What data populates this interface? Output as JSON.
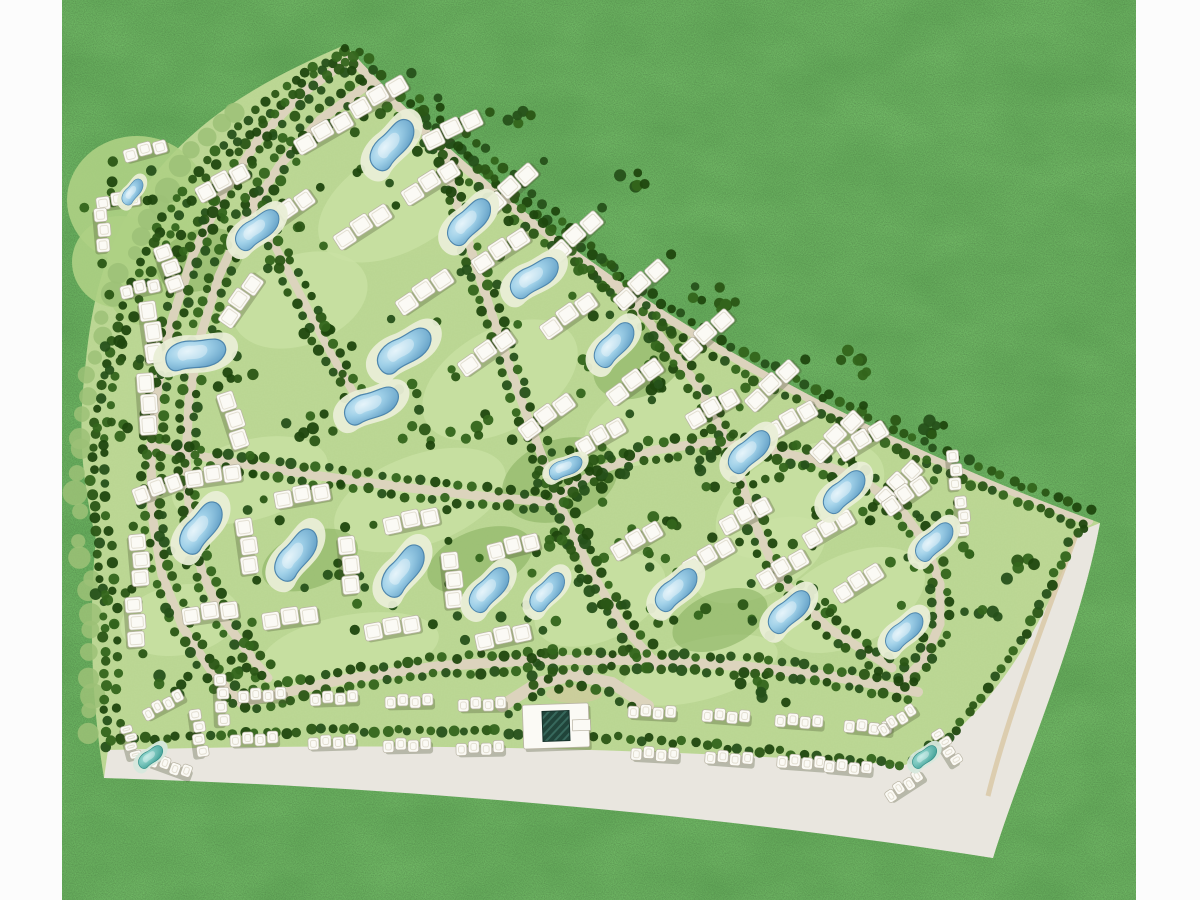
{
  "map": {
    "aria_label": "Aerial master plan site map of a fan-shaped residential community with apartment blocks, swimming pools, tree-lined roads, a clubhouse and perimeter roads on a grass field",
    "type": "masterplan-siteplan",
    "visible_text": "none"
  },
  "canvas": {
    "width": 1200,
    "height": 900
  },
  "palette": {
    "page_bg": "#fdfdfd",
    "grass_base": "#46763a",
    "margin_white": "#fcfcfc",
    "lawn": "#b4d28a",
    "lawn_light": "#c9e2a4",
    "lawn_dark": "#8ab263",
    "halo": "#aed084",
    "fringe": "#9cc177",
    "road": "#ddd3bf",
    "road_band": "#e9e6df",
    "road_tan": "#d8c7a2",
    "tree_colors": [
      "#1f470e",
      "#2a5615",
      "#33651b",
      "#26511a"
    ],
    "building_fill": "#fbfaf5",
    "building_stroke": "#b9b4a4",
    "building_inner": "#e3dfd2",
    "building_shadow": "rgba(70,80,45,0.30)",
    "pool_deck": "#e9eed6",
    "pool_stroke": "#4e86ad",
    "teal_deck": "#d6e8dc",
    "teal_stroke": "#2e8c84",
    "clubhouse_core": "#20443a",
    "clubhouse_hatch": "#37685c"
  },
  "margins": {
    "left": {
      "x": 0,
      "w": 62
    },
    "right": {
      "x": 1136,
      "w": 64
    }
  },
  "site": {
    "outline": "M345,45 Q622,348 1100,523 C1078,640 1020,770 993,858 C700,810 380,783 104,778 C92,706 88,616 96,540 C80,470 78,428 86,360 C92,300 106,238 150,180 C198,118 262,80 345,45 Z",
    "band": "M108,750 C400,742 640,748 905,765 C975,735 1040,640 1078,532 L1100,523 C1078,640 1020,770 993,858 C700,812 380,786 104,778 Z",
    "tan_strip": "M1076,535 C1042,626 1006,722 988,796"
  },
  "roads": {
    "paths": {
      "A1": [
        [
          348,
          60
        ],
        [
          300,
          95
        ],
        [
          258,
          140
        ],
        [
          222,
          195
        ],
        [
          193,
          255
        ],
        [
          172,
          320
        ],
        [
          158,
          385
        ],
        [
          151,
          450
        ],
        [
          152,
          515
        ],
        [
          162,
          575
        ],
        [
          183,
          628
        ],
        [
          212,
          672
        ],
        [
          242,
          704
        ]
      ],
      "A2": [
        [
          366,
          86
        ],
        [
          320,
          120
        ],
        [
          280,
          165
        ],
        [
          246,
          218
        ],
        [
          219,
          276
        ],
        [
          200,
          338
        ],
        [
          189,
          400
        ],
        [
          186,
          460
        ],
        [
          190,
          518
        ],
        [
          202,
          572
        ],
        [
          224,
          620
        ],
        [
          252,
          658
        ],
        [
          268,
          678
        ]
      ],
      "B": [
        [
          352,
          58
        ],
        [
          408,
          115
        ],
        [
          468,
          169
        ],
        [
          532,
          221
        ],
        [
          599,
          271
        ],
        [
          671,
          319
        ],
        [
          747,
          364
        ],
        [
          826,
          406
        ],
        [
          909,
          447
        ],
        [
          997,
          484
        ],
        [
          1088,
          520
        ]
      ],
      "C": [
        [
          428,
          98
        ],
        [
          443,
          155
        ],
        [
          460,
          215
        ],
        [
          478,
          272
        ],
        [
          497,
          330
        ],
        [
          517,
          388
        ],
        [
          538,
          446
        ],
        [
          560,
          505
        ],
        [
          588,
          566
        ],
        [
          622,
          625
        ],
        [
          660,
          668
        ]
      ],
      "D": [
        [
          150,
          446
        ],
        [
          230,
          462
        ],
        [
          320,
          476
        ],
        [
          410,
          488
        ],
        [
          490,
          497
        ],
        [
          548,
          502
        ]
      ],
      "E": [
        [
          548,
          502
        ],
        [
          600,
          470
        ],
        [
          655,
          450
        ],
        [
          710,
          442
        ],
        [
          762,
          448
        ],
        [
          812,
          460
        ]
      ],
      "F": [
        [
          812,
          460
        ],
        [
          862,
          480
        ],
        [
          900,
          508
        ],
        [
          926,
          544
        ],
        [
          940,
          584
        ],
        [
          940,
          624
        ],
        [
          924,
          660
        ],
        [
          900,
          684
        ]
      ],
      "G": [
        [
          244,
          702
        ],
        [
          340,
          680
        ],
        [
          440,
          666
        ],
        [
          540,
          660
        ],
        [
          640,
          660
        ],
        [
          740,
          666
        ],
        [
          830,
          676
        ],
        [
          918,
          692
        ]
      ],
      "H": [
        [
          250,
          196
        ],
        [
          276,
          248
        ],
        [
          303,
          300
        ],
        [
          330,
          352
        ],
        [
          360,
          404
        ]
      ],
      "I": [
        [
          452,
          130
        ],
        [
          520,
          192
        ],
        [
          586,
          254
        ],
        [
          646,
          318
        ],
        [
          698,
          386
        ],
        [
          734,
          454
        ],
        [
          752,
          518
        ],
        [
          778,
          576
        ],
        [
          828,
          628
        ],
        [
          892,
          668
        ]
      ],
      "L": [
        [
          345,
          48
        ],
        [
          296,
          80
        ],
        [
          248,
          118
        ],
        [
          204,
          162
        ],
        [
          168,
          212
        ],
        [
          140,
          266
        ],
        [
          118,
          322
        ],
        [
          102,
          378
        ],
        [
          94,
          436
        ],
        [
          92,
          492
        ],
        [
          98,
          548
        ],
        [
          103,
          602
        ],
        [
          105,
          656
        ],
        [
          106,
          710
        ],
        [
          107,
          748
        ]
      ],
      "BT": [
        [
          112,
          746
        ],
        [
          190,
          740
        ],
        [
          270,
          736
        ],
        [
          352,
          734
        ],
        [
          434,
          734
        ],
        [
          516,
          736
        ],
        [
          598,
          740
        ],
        [
          680,
          746
        ],
        [
          760,
          754
        ],
        [
          838,
          762
        ],
        [
          902,
          768
        ],
        [
          952,
          738
        ],
        [
          990,
          694
        ],
        [
          1022,
          646
        ],
        [
          1050,
          596
        ],
        [
          1072,
          548
        ],
        [
          1086,
          528
        ]
      ],
      "PL": [
        [
          502,
          706
        ],
        [
          538,
          683
        ],
        [
          574,
          675
        ],
        [
          612,
          683
        ],
        [
          648,
          706
        ]
      ]
    },
    "draw": [
      [
        "A1",
        9
      ],
      [
        "A2",
        9
      ],
      [
        "B",
        11
      ],
      [
        "C",
        9
      ],
      [
        "D",
        9
      ],
      [
        "E",
        9
      ],
      [
        "F",
        9
      ],
      [
        "G",
        10
      ],
      [
        "H",
        8
      ],
      [
        "I",
        9
      ],
      [
        "PL",
        12
      ]
    ]
  },
  "tree_rows": [
    {
      "p": "A1",
      "o": 8
    },
    {
      "p": "A1",
      "o": -8
    },
    {
      "p": "A2",
      "o": 8
    },
    {
      "p": "A2",
      "o": -8
    },
    {
      "p": "B",
      "o": 9,
      "s": 12
    },
    {
      "p": "B",
      "o": -9,
      "s": 12
    },
    {
      "p": "C",
      "o": 8
    },
    {
      "p": "C",
      "o": -8
    },
    {
      "p": "D",
      "o": 8
    },
    {
      "p": "D",
      "o": -8
    },
    {
      "p": "E",
      "o": 8
    },
    {
      "p": "E",
      "o": -8
    },
    {
      "p": "F",
      "o": 8
    },
    {
      "p": "F",
      "o": -8
    },
    {
      "p": "G",
      "o": 8,
      "s": 12
    },
    {
      "p": "G",
      "o": -8,
      "s": 12
    },
    {
      "p": "H",
      "o": 8
    },
    {
      "p": "H",
      "o": -8
    },
    {
      "p": "I",
      "o": 8
    },
    {
      "p": "I",
      "o": -8
    },
    {
      "p": "L",
      "o": 0,
      "s": 12
    },
    {
      "p": "L",
      "o": -12,
      "s": 16
    },
    {
      "p": "BT",
      "o": -4,
      "s": 11
    },
    {
      "p": "PL",
      "o": 10,
      "s": 15
    }
  ],
  "tree_clusters": [
    [
      600,
      470,
      16,
      42
    ],
    [
      648,
      528,
      12,
      36
    ],
    [
      562,
      540,
      10,
      32
    ],
    [
      660,
      384,
      10,
      34
    ],
    [
      700,
      300,
      8,
      30
    ],
    [
      860,
      360,
      6,
      28
    ],
    [
      930,
      430,
      6,
      26
    ],
    [
      240,
      660,
      8,
      34
    ],
    [
      540,
      662,
      8,
      30
    ],
    [
      760,
      692,
      8,
      32
    ],
    [
      640,
      180,
      5,
      28
    ],
    [
      520,
      118,
      5,
      26
    ],
    [
      280,
      142,
      5,
      26
    ],
    [
      180,
      242,
      6,
      26
    ],
    [
      120,
      362,
      6,
      26
    ],
    [
      112,
      442,
      6,
      26
    ],
    [
      115,
      600,
      6,
      30
    ],
    [
      182,
      680,
      6,
      26
    ],
    [
      1015,
      565,
      5,
      24
    ],
    [
      985,
      612,
      5,
      22
    ],
    [
      300,
      430,
      6,
      30
    ],
    [
      210,
      210,
      5,
      24
    ],
    [
      430,
      440,
      6,
      28
    ],
    [
      330,
      330,
      6,
      28
    ],
    [
      250,
      370,
      5,
      26
    ],
    [
      610,
      600,
      6,
      26
    ],
    [
      480,
      430,
      5,
      24
    ],
    [
      700,
      470,
      6,
      26
    ]
  ],
  "patches": {
    "light": [
      [
        400,
        200,
        90,
        50,
        -30
      ],
      [
        300,
        300,
        70,
        45,
        -20
      ],
      [
        500,
        380,
        85,
        50,
        -30
      ],
      [
        250,
        480,
        80,
        40,
        -15
      ],
      [
        420,
        500,
        90,
        45,
        -20
      ],
      [
        650,
        420,
        70,
        40,
        -25
      ],
      [
        800,
        500,
        90,
        50,
        -25
      ],
      [
        850,
        600,
        80,
        45,
        -25
      ],
      [
        600,
        600,
        70,
        40,
        -25
      ],
      [
        350,
        650,
        90,
        35,
        -10
      ],
      [
        180,
        620,
        60,
        35,
        -10
      ],
      [
        700,
        670,
        80,
        30,
        -15
      ],
      [
        560,
        160,
        60,
        35,
        -35
      ],
      [
        760,
        560,
        70,
        35,
        -25
      ]
    ],
    "dark": [
      [
        560,
        480,
        60,
        40,
        -20
      ],
      [
        640,
        360,
        50,
        35,
        -30
      ],
      [
        200,
        260,
        45,
        30,
        -20
      ],
      [
        480,
        560,
        55,
        30,
        -20
      ],
      [
        310,
        560,
        50,
        28,
        -20
      ],
      [
        720,
        620,
        50,
        28,
        -22
      ]
    ],
    "halos": [
      [
        137,
        200,
        70,
        64
      ],
      [
        120,
        262,
        48,
        46
      ],
      [
        150,
        296,
        40,
        30
      ]
    ]
  },
  "buildings": [
    [
      378,
      96,
      -30
    ],
    [
      323,
      132,
      -30
    ],
    [
      452,
      129,
      -26
    ],
    [
      510,
      188,
      -42
    ],
    [
      575,
      236,
      -42
    ],
    [
      640,
      284,
      -42
    ],
    [
      706,
      334,
      -42
    ],
    [
      771,
      385,
      -43
    ],
    [
      836,
      436,
      -44
    ],
    [
      898,
      483,
      -45,
      54
    ],
    [
      145,
      150,
      -15,
      44,
      13
    ],
    [
      118,
      200,
      -8,
      44,
      13
    ],
    [
      103,
      230,
      85,
      44,
      13
    ],
    [
      140,
      288,
      -12,
      40,
      13
    ],
    [
      222,
      182,
      -28,
      56
    ],
    [
      288,
      210,
      -35,
      56
    ],
    [
      170,
      268,
      70,
      48
    ],
    [
      152,
      332,
      82
    ],
    [
      148,
      404,
      86
    ],
    [
      240,
      300,
      -55,
      58
    ],
    [
      234,
      420,
      72,
      58
    ],
    [
      430,
      182,
      -32
    ],
    [
      500,
      250,
      -33
    ],
    [
      568,
      315,
      -35
    ],
    [
      634,
      381,
      -36
    ],
    [
      362,
      226,
      -33
    ],
    [
      424,
      291,
      -34
    ],
    [
      486,
      352,
      -35
    ],
    [
      546,
      416,
      -36
    ],
    [
      600,
      436,
      -30,
      52
    ],
    [
      712,
      408,
      -30,
      56
    ],
    [
      790,
      420,
      -30,
      56
    ],
    [
      862,
      440,
      -32,
      54
    ],
    [
      905,
      495,
      -35,
      50
    ],
    [
      745,
      515,
      -28,
      54
    ],
    [
      828,
      528,
      -30,
      54
    ],
    [
      636,
      540,
      -30,
      54
    ],
    [
      708,
      556,
      -30,
      54
    ],
    [
      782,
      568,
      -30,
      54
    ],
    [
      858,
      582,
      -32,
      52
    ],
    [
      955,
      470,
      85,
      40,
      12
    ],
    [
      963,
      516,
      85,
      40,
      12
    ],
    [
      157,
      488,
      -20,
      50
    ],
    [
      213,
      475,
      -8,
      56
    ],
    [
      302,
      495,
      -10,
      56
    ],
    [
      411,
      520,
      -12,
      56
    ],
    [
      513,
      546,
      -14,
      52
    ],
    [
      248,
      546,
      82,
      56
    ],
    [
      350,
      565,
      84,
      58
    ],
    [
      453,
      580,
      84,
      56
    ],
    [
      140,
      560,
      85,
      52
    ],
    [
      136,
      622,
      86,
      50
    ],
    [
      210,
      612,
      -8,
      56
    ],
    [
      290,
      617,
      -8,
      56
    ],
    [
      392,
      627,
      -10,
      56
    ],
    [
      503,
      636,
      -12,
      56
    ]
  ],
  "townhouses": [
    [
      262,
      695,
      -2
    ],
    [
      334,
      698,
      -2
    ],
    [
      409,
      701,
      -1
    ],
    [
      482,
      704,
      -1
    ],
    [
      652,
      712,
      3
    ],
    [
      726,
      716,
      4
    ],
    [
      799,
      721,
      4
    ],
    [
      868,
      727,
      5
    ],
    [
      254,
      739,
      -2
    ],
    [
      332,
      742,
      -2
    ],
    [
      407,
      745,
      -1
    ],
    [
      480,
      748,
      -1
    ],
    [
      655,
      754,
      3
    ],
    [
      729,
      758,
      4
    ],
    [
      801,
      762,
      4
    ],
    [
      848,
      767,
      5
    ],
    [
      163,
      705,
      -28,
      44
    ],
    [
      199,
      733,
      82,
      48
    ],
    [
      170,
      766,
      20,
      44
    ],
    [
      131,
      742,
      75,
      34
    ],
    [
      222,
      700,
      88,
      52
    ],
    [
      897,
      720,
      -32,
      42
    ],
    [
      947,
      747,
      58,
      40
    ],
    [
      904,
      786,
      -33,
      42
    ]
  ],
  "pools": [
    [
      393,
      145,
      -52,
      0.9,
      0
    ],
    [
      470,
      222,
      -48,
      0.85,
      0
    ],
    [
      535,
      278,
      -35,
      0.85,
      0
    ],
    [
      615,
      345,
      -50,
      0.8,
      0
    ],
    [
      133,
      192,
      -55,
      0.45,
      0
    ],
    [
      258,
      230,
      -40,
      0.8,
      0
    ],
    [
      196,
      355,
      -12,
      0.95,
      0
    ],
    [
      405,
      351,
      -35,
      0.95,
      0
    ],
    [
      372,
      406,
      -25,
      0.9,
      0
    ],
    [
      566,
      468,
      -26,
      0.55,
      0
    ],
    [
      202,
      528,
      -55,
      0.9,
      0
    ],
    [
      297,
      555,
      -55,
      0.9,
      0
    ],
    [
      404,
      571,
      -55,
      0.9,
      0
    ],
    [
      490,
      590,
      -50,
      0.8,
      0
    ],
    [
      548,
      592,
      -50,
      0.7,
      0
    ],
    [
      677,
      590,
      -45,
      0.8,
      0
    ],
    [
      790,
      612,
      -45,
      0.8,
      0
    ],
    [
      905,
      632,
      -45,
      0.72,
      0
    ],
    [
      750,
      452,
      -45,
      0.8,
      0
    ],
    [
      845,
      492,
      -45,
      0.8,
      0
    ],
    [
      935,
      542,
      -45,
      0.72,
      0
    ],
    [
      151,
      757,
      -40,
      0.45,
      1
    ],
    [
      925,
      757,
      -40,
      0.45,
      1
    ]
  ],
  "clubhouse": {
    "x": 556,
    "y": 726,
    "rot": -2,
    "w": 66,
    "h": 44,
    "core_w": 27,
    "core_h": 30,
    "wing_w": 18,
    "wing_h": 11
  },
  "roundabout": {
    "x": 574,
    "y": 694,
    "rx": 28,
    "ry": 9
  }
}
